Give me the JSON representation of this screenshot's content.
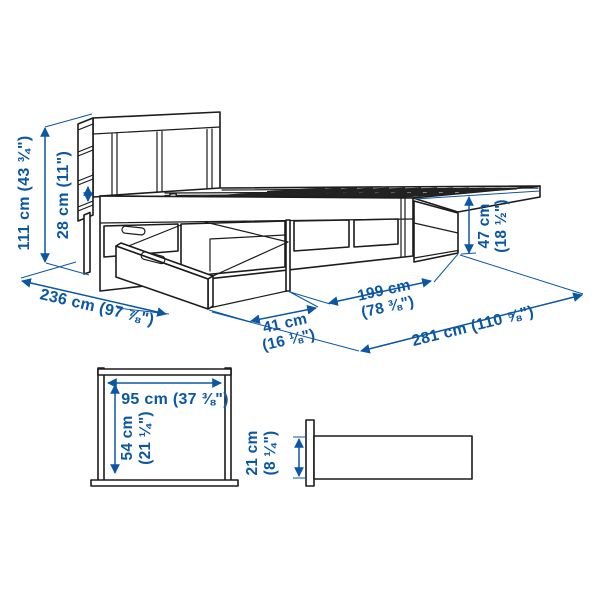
{
  "meta": {
    "kind": "product dimension line drawing",
    "product_hint": "storage bed with headboard shelves and pull-out drawers",
    "background": "#ffffff",
    "accent_blue": "#0b57a4",
    "line_black": "#1c1c1c"
  },
  "dimensions": {
    "headboard_height": "111 cm (43 ¾\")",
    "shelf_gap": "28 cm (11\")",
    "bed_width_diagonal": "236 cm (97 ⅞\")",
    "drawer_pullout_cm": "41 cm",
    "drawer_pullout_in": "(16 ⅛\")",
    "frame_length_cm": "199 cm",
    "frame_length_in": "(78 ⅜\")",
    "total_length": "281 cm (110 ⅝\")",
    "foot_height_cm": "47 cm",
    "foot_height_in": "(18 ½\")"
  },
  "front_view": {
    "width": "95 cm (37 ⅜\")",
    "height_cm": "54 cm",
    "height_in": "(21 ¼\")"
  },
  "side_view": {
    "height_cm": "21 cm",
    "height_in": "(8 ¼\")"
  }
}
